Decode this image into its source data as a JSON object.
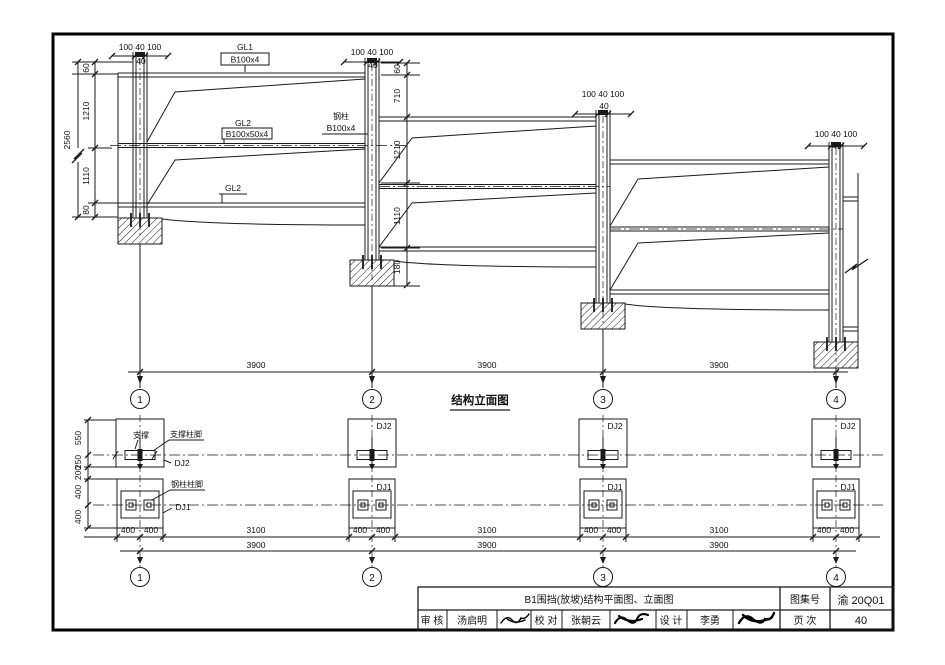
{
  "elevation": {
    "title": "结构立面图",
    "cap_dim": "100 40 100",
    "cap_sub": "40",
    "labels": {
      "gl1": "GL1",
      "gl1_spec": "B100x4",
      "gl2": "GL2",
      "gl2_spec": "B100x50x4",
      "col": "钢柱",
      "col_spec": "B100x4",
      "gl2b": "GL2"
    },
    "left_chain": {
      "total": "2560",
      "segs": [
        "60",
        "1210",
        "1110",
        "80"
      ]
    },
    "mid_chain": {
      "segs": [
        "60",
        "710",
        "1210",
        "1110",
        "180"
      ]
    },
    "spans": [
      "3900",
      "3900",
      "3900"
    ],
    "axes": [
      "1",
      "2",
      "3",
      "4"
    ]
  },
  "plan": {
    "left_chain": [
      "550",
      "250",
      "200",
      "400",
      "400"
    ],
    "labels": {
      "brace": "支撑",
      "brace_base": "支撑柱脚",
      "dj2": "DJ2",
      "col_base": "钢柱柱脚",
      "dj1": "DJ1"
    },
    "row1_dims": [
      "400",
      "400",
      "3100",
      "400",
      "400",
      "3100",
      "400",
      "400",
      "3100",
      "400",
      "400"
    ],
    "row2_dims": [
      "3900",
      "3900",
      "3900"
    ],
    "axes": [
      "1",
      "2",
      "3",
      "4"
    ]
  },
  "titleblock": {
    "sheet_title": "B1围挡(放坡)结构平面图、立面图",
    "atlas_label": "图集号",
    "atlas_no": "渝 20Q01",
    "page_label": "页 次",
    "page_no": "40",
    "roles": [
      {
        "label": "审 核",
        "name": "汤启明"
      },
      {
        "label": "校 对",
        "name": "张朝云"
      },
      {
        "label": "设 计",
        "name": "李勇"
      }
    ]
  }
}
